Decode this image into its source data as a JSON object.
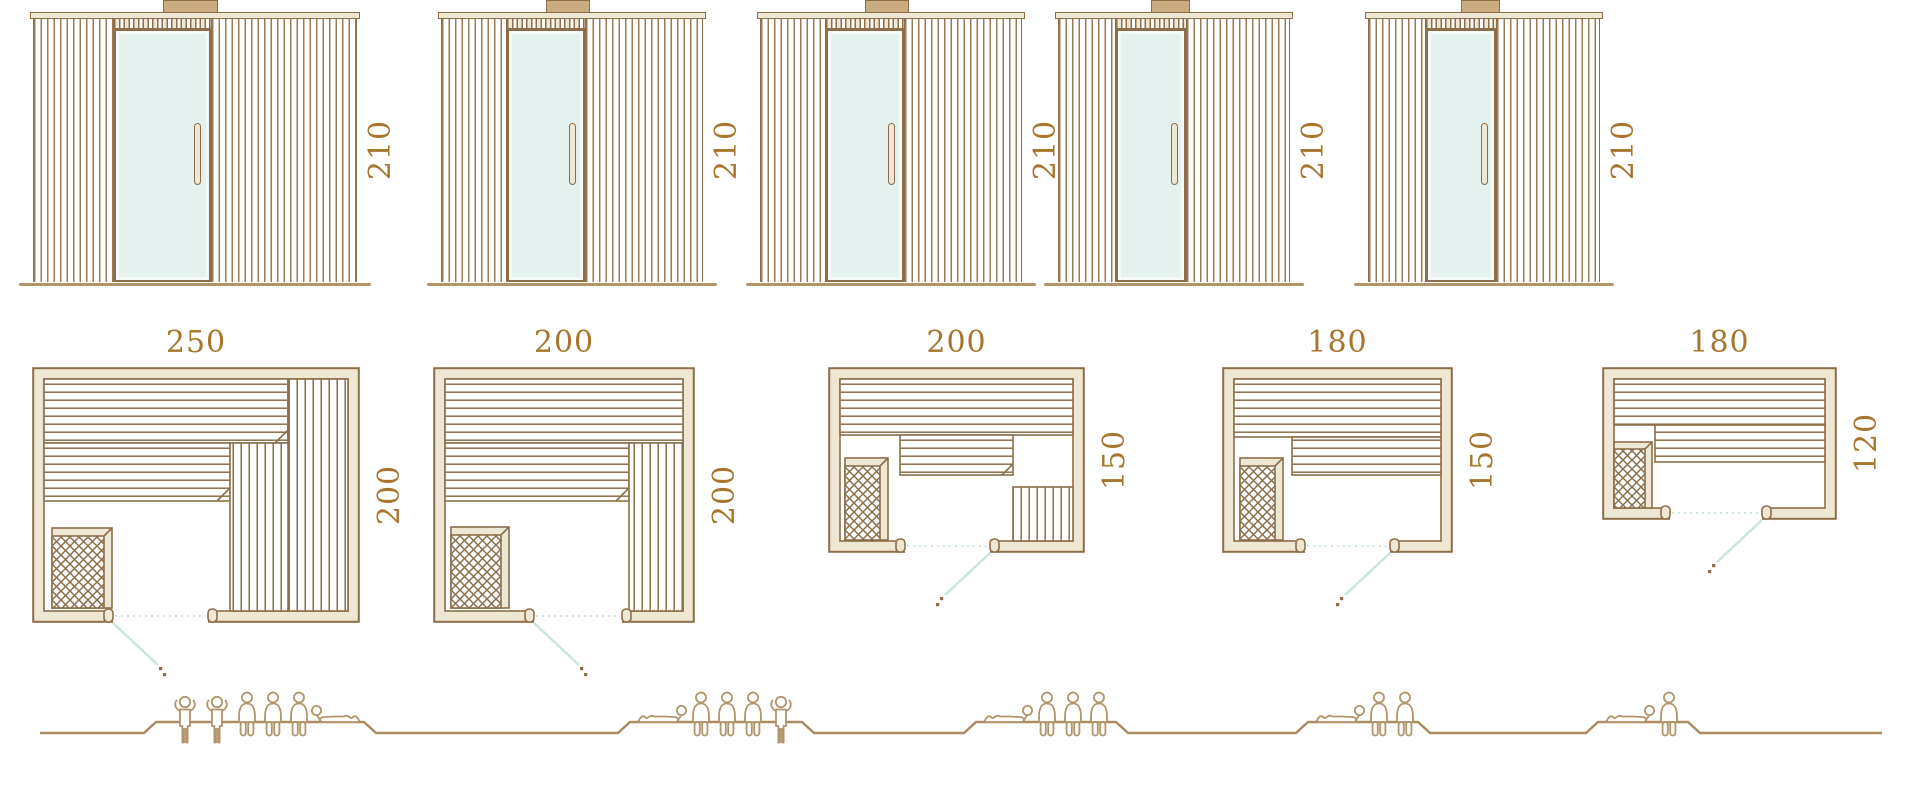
{
  "palette": {
    "outline_brown": "#8d6e49",
    "slat_brown": "#9c7b54",
    "wood_beige": "#ede7d3",
    "glass_mint": "#e4f1ee",
    "dimension_text": "#a7762e",
    "ground_tan": "#b29468",
    "people_tan": "#b2946a",
    "door_swing_teal": "#c8e4dd"
  },
  "saunas": [
    {
      "elevation": {
        "height_label": "210"
      },
      "plan": {
        "width_label": "250",
        "depth_label": "200"
      },
      "people": [
        "standing",
        "standing",
        "seated",
        "seated",
        "seated",
        "reclining-right"
      ],
      "capacity": {
        "standing": 2,
        "seated": 3,
        "reclining": 1,
        "total": 6
      }
    },
    {
      "elevation": {
        "height_label": "210"
      },
      "plan": {
        "width_label": "200",
        "depth_label": "200"
      },
      "people": [
        "reclining-left",
        "seated",
        "seated",
        "seated",
        "standing"
      ],
      "capacity": {
        "standing": 1,
        "seated": 3,
        "reclining": 1,
        "total": 5
      }
    },
    {
      "elevation": {
        "height_label": "210"
      },
      "plan": {
        "width_label": "200",
        "depth_label": "150"
      },
      "people": [
        "reclining-left",
        "seated",
        "seated",
        "seated"
      ],
      "capacity": {
        "standing": 0,
        "seated": 3,
        "reclining": 1,
        "total": 4
      }
    },
    {
      "elevation": {
        "height_label": "210"
      },
      "plan": {
        "width_label": "180",
        "depth_label": "150"
      },
      "people": [
        "reclining-left",
        "seated",
        "seated"
      ],
      "capacity": {
        "standing": 0,
        "seated": 2,
        "reclining": 1,
        "total": 3
      }
    },
    {
      "elevation": {
        "height_label": "210"
      },
      "plan": {
        "width_label": "180",
        "depth_label": "120"
      },
      "people": [
        "reclining-left",
        "seated"
      ],
      "capacity": {
        "standing": 0,
        "seated": 1,
        "reclining": 1,
        "total": 2
      }
    }
  ]
}
